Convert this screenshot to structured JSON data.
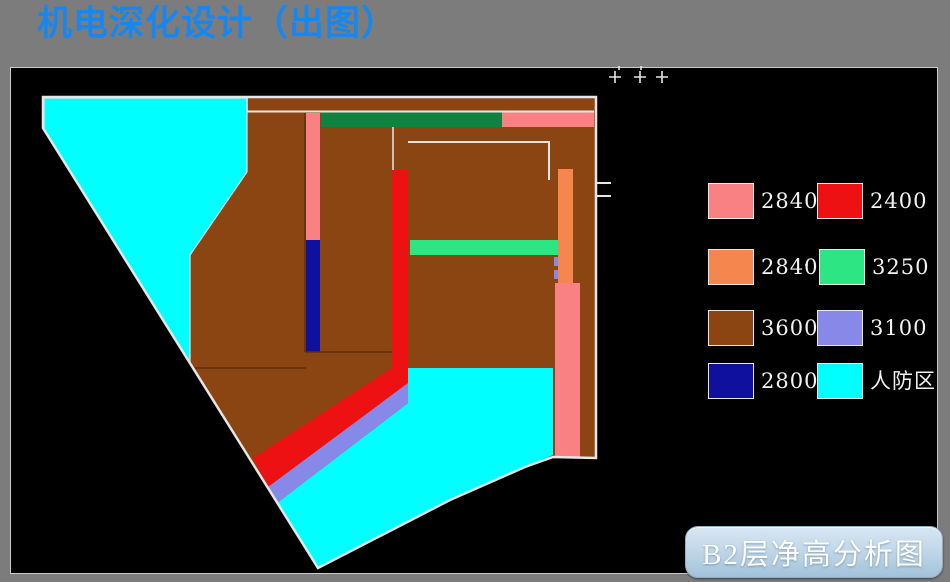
{
  "header": {
    "title": "机电深化设计（出图）"
  },
  "caption": {
    "label": "B2层净高分析图"
  },
  "legend": {
    "dot": "·",
    "items": [
      {
        "name": "height-2840-pink",
        "label": "2840",
        "color": "#F98184"
      },
      {
        "name": "height-2400-red",
        "label": "2400",
        "color": "#EE1113"
      },
      {
        "name": "height-2840-orange",
        "label": "2840",
        "color": "#F5874E"
      },
      {
        "name": "height-3250-green",
        "label": "3250",
        "color": "#2EE583"
      },
      {
        "name": "height-3600-brown",
        "label": "3600",
        "color": "#8B4513"
      },
      {
        "name": "height-3100-violet",
        "label": "3100",
        "color": "#8888E8"
      },
      {
        "name": "height-2800-navy",
        "label": "2800",
        "color": "#10109E"
      },
      {
        "name": "civil-defense-cyan",
        "label": "人防区",
        "color": "#00FFFF"
      }
    ]
  },
  "palette": {
    "frame_gray": "#7C7C7C",
    "canvas_black": "#000000",
    "title_blue": "#1787EF",
    "outline_white": "#E6E6E6",
    "brown": "#8B4513",
    "cyan": "#00FFFF",
    "pink": "#F98184",
    "red": "#EE1113",
    "orange": "#F5874E",
    "spring_green": "#2EE583",
    "dark_green": "#128040",
    "navy": "#10109E",
    "violet": "#8888E8",
    "inner_line_dark": "#5E2F0E"
  }
}
